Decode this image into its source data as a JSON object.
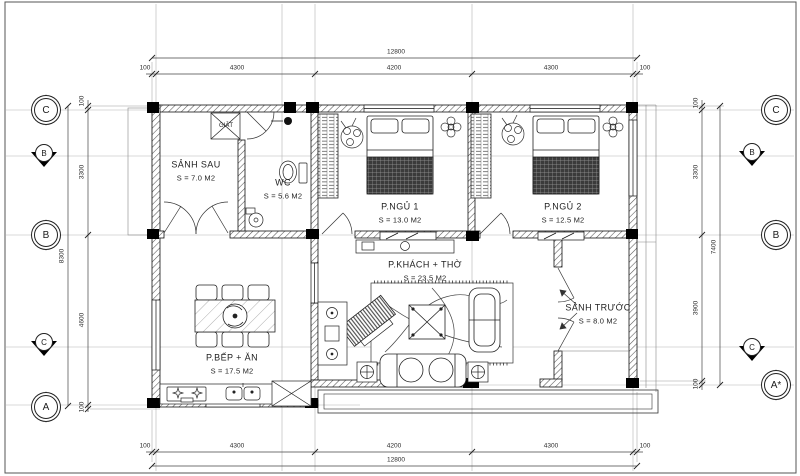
{
  "grid": {
    "rows_left": [
      {
        "label": "C"
      },
      {
        "label": "B"
      },
      {
        "label": "A"
      }
    ],
    "rows_right": [
      {
        "label": "C"
      },
      {
        "label": "B"
      },
      {
        "label": "A*"
      }
    ],
    "sections_left": [
      {
        "label": "B"
      },
      {
        "label": "C"
      }
    ],
    "sections_right": [
      {
        "label": "B"
      },
      {
        "label": "C"
      }
    ]
  },
  "dimensions": {
    "top": {
      "overall": "12800",
      "segments": [
        "100",
        "4300",
        "4200",
        "4300",
        "100"
      ]
    },
    "bottom": {
      "overall": "12800",
      "segments": [
        "100",
        "4300",
        "4200",
        "4300",
        "100"
      ]
    },
    "left": {
      "overall": "8300",
      "segments": [
        "100",
        "3300",
        "4600",
        "100"
      ]
    },
    "right": {
      "overall": "7400",
      "segments": [
        "100",
        "3300",
        "3900",
        "100"
      ]
    }
  },
  "rooms": [
    {
      "id": "sanh-sau",
      "name": "SẢNH SAU",
      "area": "S = 7.0 M2"
    },
    {
      "id": "wc",
      "name": "WC",
      "area": "S = 5.6 M2"
    },
    {
      "id": "p-ngu-1",
      "name": "P.NGỦ 1",
      "area": "S = 13.0 M2"
    },
    {
      "id": "p-ngu-2",
      "name": "P.NGỦ 2",
      "area": "S = 12.5 M2"
    },
    {
      "id": "p-khach-tho",
      "name": "P.KHÁCH + THỜ",
      "area": "S = 23.5 M2"
    },
    {
      "id": "sanh-truoc",
      "name": "SẢNH TRƯỚC",
      "area": "S = 8.0 M2"
    },
    {
      "id": "p-bep-an",
      "name": "P.BẾP + ĂN",
      "area": "S = 17.5 M2"
    }
  ],
  "annotations": {
    "laundry": "GIẶT"
  }
}
